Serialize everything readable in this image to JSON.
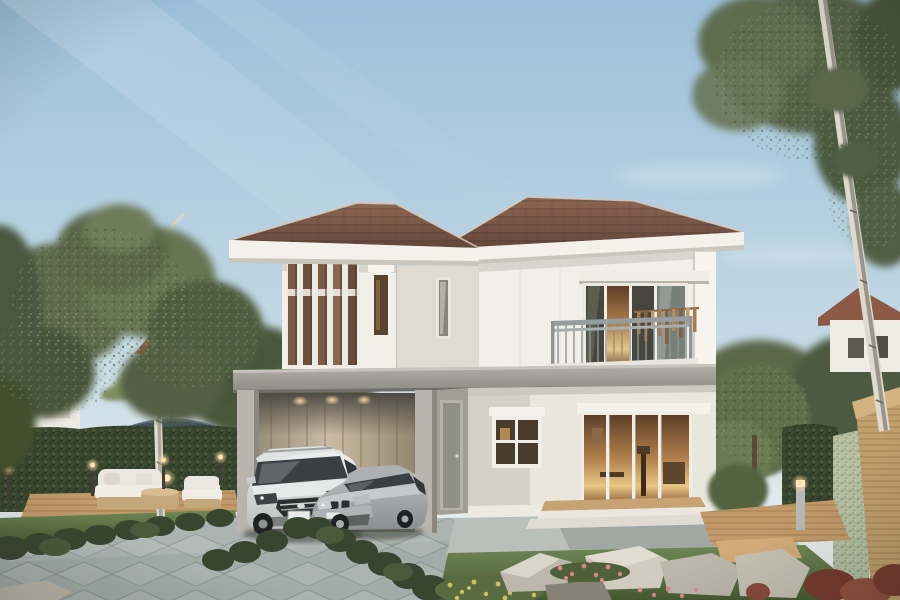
{
  "scene": {
    "type": "exterior-architectural-rendering",
    "subject": "Modern two-storey white detached house with brown hip roof, carport with two parked cars, balcony, timber louver screen and landscaped garden",
    "objects": [
      "sky",
      "sunbeams",
      "birch-tree-left",
      "birch-tree-right",
      "neighbor-house-left",
      "neighbor-house-right",
      "hedge-wall",
      "patio-umbrella",
      "outdoor-lounge-set",
      "garden-bollard-lights",
      "main-house",
      "brown-hip-roof",
      "timber-louver-screen",
      "balcony",
      "wind-chimes",
      "sliding-glass-doors",
      "carport",
      "white-suv",
      "silver-sedan",
      "tiled-driveway",
      "lawn",
      "boxwood-hedgerows",
      "rock-garden",
      "flower-beds",
      "wooden-walkway",
      "timber-fence-post",
      "stone-garden-wall"
    ],
    "text": []
  },
  "colors": {
    "sky_top": "#9cc0da",
    "sky_mid": "#c2d8e4",
    "sky_low": "#e2ebec",
    "canopy_dark": "#46543a",
    "canopy_mid": "#5b6b48",
    "canopy_light": "#73845c",
    "trunk": "#e0dcd1",
    "trunk_dark": "#6b675c",
    "hedge": "#39462f",
    "hedge_light": "#4d5c3e",
    "grass": "#5a7141",
    "grass_dark": "#465a31",
    "grass_light": "#6f8755",
    "roof": "#7c5948",
    "roof_dark": "#64463b",
    "roof_edge": "#d9c9b8",
    "fascia": "#f3f1ea",
    "wall": "#f1efe8",
    "wall_shade": "#dedbd2",
    "wall_dark": "#a19e96",
    "band": "#a3a29b",
    "band_dark": "#7f7e78",
    "louver": "#7b5a45",
    "louver_dark": "#553c2e",
    "glass": "#46463e",
    "interior": "#b3824e",
    "interior_glow": "#e8c684",
    "rail": "#979d9e",
    "chime": "#a87a4e",
    "carport_wall": "#c9bba4",
    "carport_dark": "#4e4a43",
    "column": "#b7b5ae",
    "door": "#8f9088",
    "concrete": "#b9bfba",
    "tile": "#a2aca8",
    "tile_line": "#75817e",
    "deck": "#c29a6a",
    "deck_dark": "#98744a",
    "step_wood": "#c7a273",
    "rock": "#bcb7aa",
    "rock_dark": "#878276",
    "flower_pink": "#d4898d",
    "flower_yellow": "#c9c26b",
    "plant_red": "#77392f",
    "umbrella": "#5c707e",
    "umbrella_dark": "#42525c",
    "sofa": "#eae7df",
    "wicker": "#c5a77c",
    "car_white": "#edefee",
    "car_white_shade": "#bcbfbe",
    "car_silver": "#bdbfc0",
    "car_silver_shade": "#8b8e90",
    "car_glass": "#3a3f41",
    "car_trim": "#2c2f30",
    "glow": "#ffd9a0",
    "bg_roof": "#9a6049",
    "bg_wall": "#ece9e1",
    "stone_wall": "#b7c1a2",
    "wood_post": "#c2a06d"
  }
}
